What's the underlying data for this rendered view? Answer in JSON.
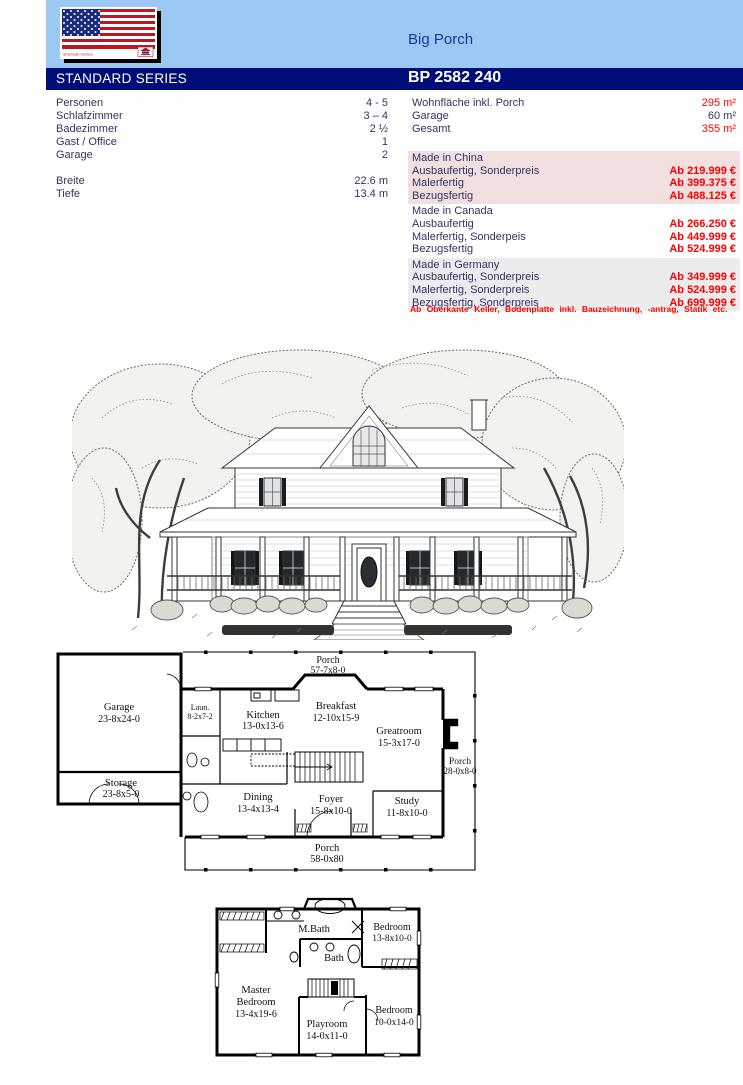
{
  "header": {
    "title": "Big Porch",
    "series": "STANDARD SERIES",
    "model": "BP 2582 240"
  },
  "logo": {
    "caption": "american homes"
  },
  "specs_left": [
    {
      "label": "Personen",
      "value": "4 - 5"
    },
    {
      "label": "Schlafzimmer",
      "value": "3 – 4"
    },
    {
      "label": "Badezimmer",
      "value": "2 ½"
    },
    {
      "label": "Gast / Office",
      "value": "1"
    },
    {
      "label": "Garage",
      "value": "2"
    },
    {
      "label": "Breite",
      "value": "22.6 m"
    },
    {
      "label": "Tiefe",
      "value": "13.4 m"
    }
  ],
  "specs_right": [
    {
      "label": "Wohnfläche inkl. Porch",
      "value": "295 m²"
    },
    {
      "label": "Garage",
      "value": "60 m²"
    },
    {
      "label": "Gesamt",
      "value": "355 m²"
    }
  ],
  "price_blocks": [
    {
      "region": "Made in China",
      "rows": [
        {
          "label": "Ausbaufertig, Sonderpreis",
          "price": "Ab 219.999 €"
        },
        {
          "label": "Malerfertig",
          "price": "Ab 399.375 €"
        },
        {
          "label": "Bezugsfertig",
          "price": "Ab 488.125 €"
        }
      ]
    },
    {
      "region": "Made in Canada",
      "rows": [
        {
          "label": "Ausbaufertig",
          "price": "Ab 266.250 €"
        },
        {
          "label": "Malerfertig, Sonderpeis",
          "price": "Ab 449.999 €"
        },
        {
          "label": "Bezugsfertig",
          "price": "Ab 524.999 €"
        }
      ]
    },
    {
      "region": "Made in Germany",
      "rows": [
        {
          "label": "Ausbaufertig, Sonderpreis",
          "price": "Ab 349.999 €"
        },
        {
          "label": "Malerfertig, Sonderpreis",
          "price": "Ab 524.999 €"
        },
        {
          "label": "Bezugsfertig, Sonderpreis",
          "price": "Ab 699.999 €"
        }
      ]
    }
  ],
  "footnote": "Ab Oberkante Keller, Bodenplatte inkl. Bauzeichnung, -antrag, Statik etc.",
  "floorplan_first": {
    "porch_top": {
      "name": "Porch",
      "dim": "57-7x8-0"
    },
    "garage": {
      "name": "Garage",
      "dim": "23-8x24-0"
    },
    "laundry": {
      "name": "Laun.",
      "dim": "8-2x7-2"
    },
    "kitchen": {
      "name": "Kitchen",
      "dim": "13-0x13-6"
    },
    "breakfast": {
      "name": "Breakfast",
      "dim": "12-10x15-9"
    },
    "greatroom": {
      "name": "Greatroom",
      "dim": "15-3x17-0"
    },
    "porch_right": {
      "name": "Porch",
      "dim": "28-0x8-0"
    },
    "storage": {
      "name": "Storage",
      "dim": "23-8x5-0"
    },
    "dining": {
      "name": "Dining",
      "dim": "13-4x13-4"
    },
    "foyer": {
      "name": "Foyer",
      "dim": "15-8x10-0"
    },
    "study": {
      "name": "Study",
      "dim": "11-8x10-0"
    },
    "porch_bottom": {
      "name": "Porch",
      "dim": "58-0x80"
    }
  },
  "floorplan_second": {
    "mbath": {
      "name": "M.Bath"
    },
    "bath": {
      "name": "Bath"
    },
    "bedroom1": {
      "name": "Bedroom",
      "dim": "13-8x10-0"
    },
    "master": {
      "name1": "Master",
      "name2": "Bedroom",
      "dim": "13-4x19-6"
    },
    "playroom": {
      "name": "Playroom",
      "dim": "14-0x11-0"
    },
    "bedroom2": {
      "name": "Bedroom",
      "dim": "10-0x14-0"
    }
  },
  "colors": {
    "header_bg": "#9CC9F4",
    "bar_bg": "#000D78",
    "text_navy": "#333366",
    "title_navy": "#1A3793",
    "price_red": "#FF0000",
    "china_bg": "#F2E0E0",
    "germany_bg": "#ECECEC"
  }
}
